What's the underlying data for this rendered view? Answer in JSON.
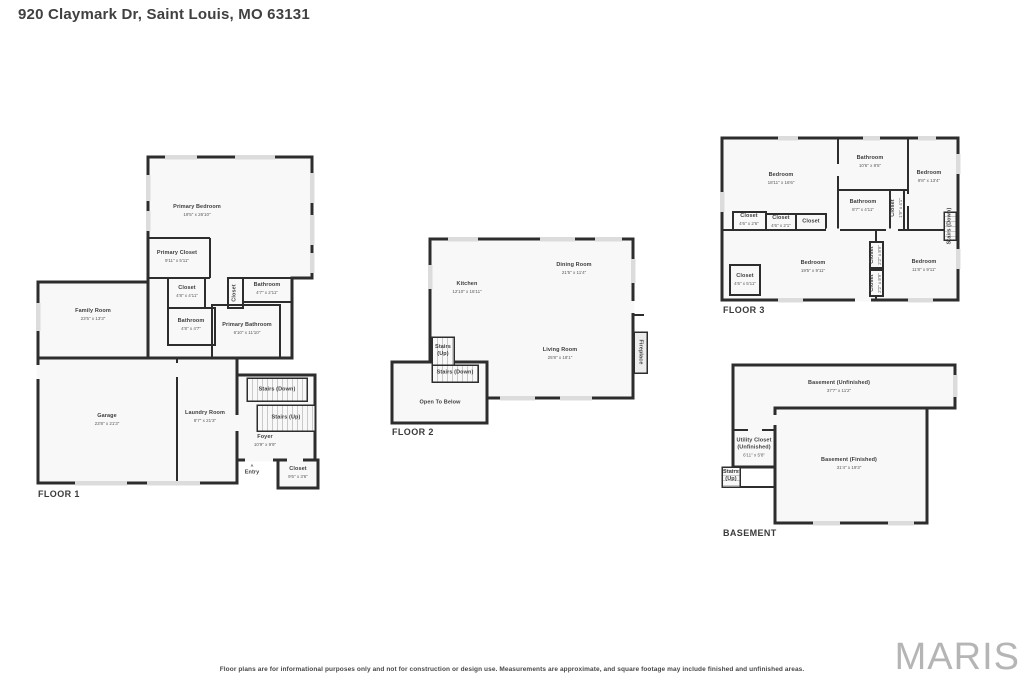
{
  "title": "920 Claymark Dr, Saint Louis, MO 63131",
  "disclaimer": "Floor plans are for informational purposes only and not for construction or design use. Measurements are approximate, and square footage may include finished and unfinished areas.",
  "watermark": "MARIS",
  "icons": {
    "entry_arrow": "▲"
  },
  "colors": {
    "wall": "#2d2d2d",
    "room_fill": "#f8f8f8",
    "window": "#dcdcdc",
    "label_text": "#3e3e3e",
    "watermark_gray": "#b5b5b8"
  },
  "floor1": {
    "label": "FLOOR 1",
    "rooms": {
      "primary_bedroom": {
        "name": "Primary Bedroom",
        "dims": "19'5\" x 26'10\""
      },
      "primary_closet": {
        "name": "Primary Closet",
        "dims": "9'11\" x 5'11\""
      },
      "closet_a": {
        "name": "Closet",
        "dims": "4'8\" x 4'11\""
      },
      "bathroom_a": {
        "name": "Bathroom",
        "dims": "4'8\" x 4'7\""
      },
      "closet_b": {
        "name": "Closet"
      },
      "bathroom_b": {
        "name": "Bathroom",
        "dims": "4'7\" x 2'11\""
      },
      "primary_bathroom": {
        "name": "Primary Bathroom",
        "dims": "6'10\" x 11'10\""
      },
      "family_room": {
        "name": "Family Room",
        "dims": "23'5\" x 13'3\""
      },
      "garage": {
        "name": "Garage",
        "dims": "23'8\" x 21'3\""
      },
      "laundry_room": {
        "name": "Laundry Room",
        "dims": "8'7\" x 21'3\""
      },
      "stairs_down": {
        "name": "Stairs (Down)"
      },
      "stairs_up": {
        "name": "Stairs (Up)"
      },
      "foyer": {
        "name": "Foyer",
        "dims": "10'9\" x 9'9\""
      },
      "entry": {
        "name": "Entry"
      },
      "closet_c": {
        "name": "Closet",
        "dims": "9'6\" x 3'6\""
      }
    }
  },
  "floor2": {
    "label": "FLOOR 2",
    "rooms": {
      "kitchen": {
        "name": "Kitchen",
        "dims": "12'10\" x 16'11\""
      },
      "dining_room": {
        "name": "Dining Room",
        "dims": "21'5\" x 11'4\""
      },
      "living_room": {
        "name": "Living Room",
        "dims": "25'8\" x 18'1\""
      },
      "stairs_up": {
        "name": "Stairs",
        "name2": "(Up)"
      },
      "stairs_down": {
        "name": "Stairs (Down)"
      },
      "open_to_below": {
        "name": "Open To Below"
      },
      "fireplace": {
        "name": "Fireplace"
      }
    }
  },
  "floor3": {
    "label": "FLOOR 3",
    "rooms": {
      "bedroom_left": {
        "name": "Bedroom",
        "dims": "18'11\" x 16'6\""
      },
      "bathroom_top": {
        "name": "Bathroom",
        "dims": "10'6\" x 8'5\""
      },
      "bedroom_right_top": {
        "name": "Bedroom",
        "dims": "9'8\" x 13'4\""
      },
      "bathroom_mid": {
        "name": "Bathroom",
        "dims": "8'7\" x 4'11\""
      },
      "closet_v1": {
        "name": "Closet",
        "dims": "1'9\" x 4'1\""
      },
      "closet_1": {
        "name": "Closet",
        "dims": "4'6\" x 2'6\""
      },
      "closet_2": {
        "name": "Closet",
        "dims": "4'6\" x 2'1\""
      },
      "closet_3": {
        "name": "Closet"
      },
      "stairs_down": {
        "name": "Stairs (Down)"
      },
      "closet_left": {
        "name": "Closet",
        "dims": "4'6\" x 5'11\""
      },
      "bedroom_mid": {
        "name": "Bedroom",
        "dims": "19'5\" x 9'11\""
      },
      "closet_v2": {
        "name": "Closet",
        "dims": "2'2\" x 8'9\""
      },
      "closet_v3": {
        "name": "Closet",
        "dims": "2'2\" x 8'9\""
      },
      "bedroom_right_bottom": {
        "name": "Bedroom",
        "dims": "11'8\" x 9'11\""
      }
    }
  },
  "basement": {
    "label": "BASEMENT",
    "rooms": {
      "unfinished": {
        "name": "Basement (Unfinished)",
        "dims": "37'7\" x 11'2\""
      },
      "utility": {
        "name": "Utility Closet",
        "name2": "(Unfinished)",
        "dims": "6'11\" x 5'8\""
      },
      "stairs_up": {
        "name": "Stairs",
        "name2": "(Up)"
      },
      "finished": {
        "name": "Basement (Finished)",
        "dims": "31'4\" x 19'3\""
      }
    }
  }
}
